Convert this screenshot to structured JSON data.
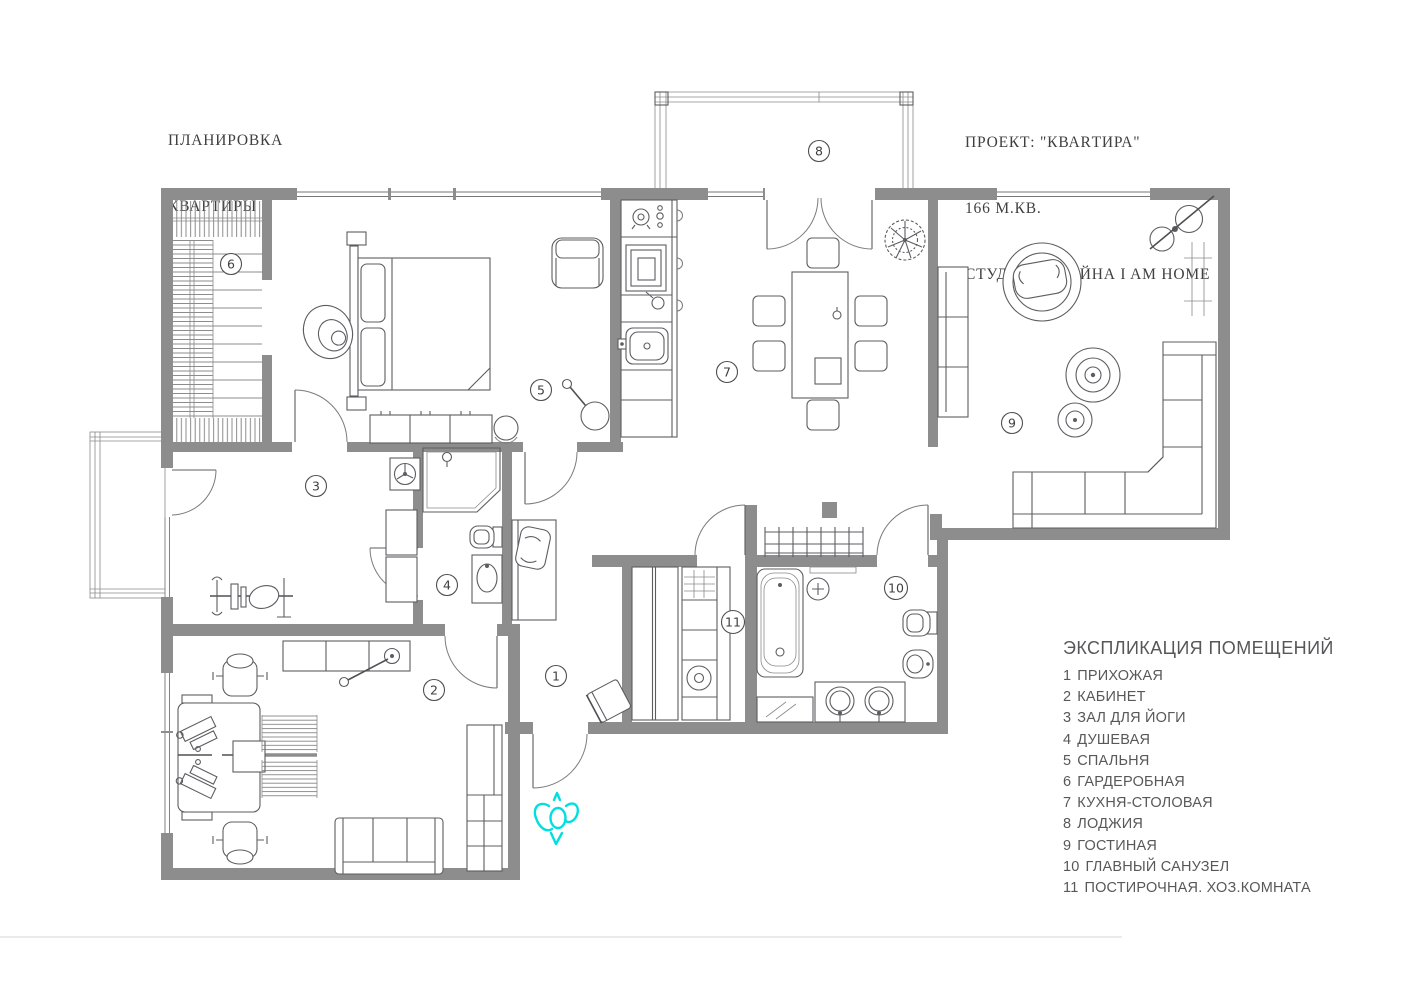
{
  "header": {
    "title_left": {
      "line1": "ПЛАНИРОВКА",
      "line2": "КВАРТИРЫ"
    },
    "project": {
      "line1": "ПРОЕКТ: \"КВАRТИРА\"",
      "line2": "166 М.КВ.",
      "line3": "СТУДИЯ ДИЗАЙНА I AM HOME"
    }
  },
  "legend": {
    "title": "ЭКСПЛИКАЦИЯ ПОМЕЩЕНИЙ",
    "items": [
      {
        "num": "1",
        "label": "ПРИХОЖАЯ"
      },
      {
        "num": "2",
        "label": "КАБИНЕТ"
      },
      {
        "num": "3",
        "label": "ЗАЛ ДЛЯ ЙОГИ"
      },
      {
        "num": "4",
        "label": "ДУШЕВАЯ"
      },
      {
        "num": "5",
        "label": "СПАЛЬНЯ"
      },
      {
        "num": "6",
        "label": "ГАРДЕРОБНАЯ"
      },
      {
        "num": "7",
        "label": "КУХНЯ-СТОЛОВАЯ"
      },
      {
        "num": "8",
        "label": "ЛОДЖИЯ"
      },
      {
        "num": "9",
        "label": "ГОСТИНАЯ"
      },
      {
        "num": "10",
        "label": "ГЛАВНЫЙ САНУЗЕЛ"
      },
      {
        "num": "11",
        "label": "ПОСТИРОЧНАЯ. ХОЗ.КОМНАТА"
      }
    ]
  },
  "plan": {
    "markers": [
      {
        "n": "1"
      },
      {
        "n": "2"
      },
      {
        "n": "3"
      },
      {
        "n": "4"
      },
      {
        "n": "5"
      },
      {
        "n": "6"
      },
      {
        "n": "7"
      },
      {
        "n": "8"
      },
      {
        "n": "9"
      },
      {
        "n": "10"
      },
      {
        "n": "11"
      }
    ],
    "colors": {
      "wall": "#8d8d8d",
      "line": "#5c5d60",
      "person_accent": "#00dfe0",
      "legend_text": "#58585a"
    }
  }
}
